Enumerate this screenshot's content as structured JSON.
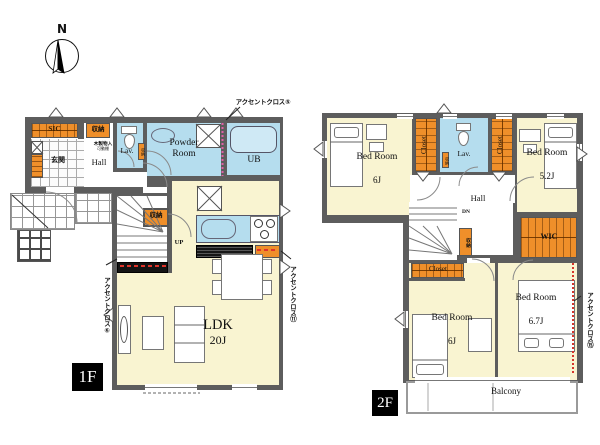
{
  "colors": {
    "wall": "#5d5d5d",
    "room_cream": "#f9f4d1",
    "wet_blue": "#b5ddee",
    "storage_orange": "#ef8f2a",
    "accent_pink": "#e160a8",
    "accent_red": "#d6352b"
  },
  "compass": {
    "north": "N"
  },
  "f1": {
    "badge": "1F",
    "sic": "SIC",
    "storage_top": "収納",
    "genkan": "玄関",
    "hall": "Hall",
    "wood_shelf": "木製物入",
    "wood_shelf_sub": "可動棚",
    "lav": "Lav.",
    "lav_storage": "収納",
    "powder_room": "Powder Room",
    "ub": "UB",
    "stair_storage": "収納",
    "up": "UP",
    "ldk": "LDK",
    "ldk_size": "20J",
    "accent_top": "アクセントクロス⑤",
    "accent_left": "アクセントクロス⑥",
    "accent_right": "アクセントクロス⑪"
  },
  "f2": {
    "badge": "2F",
    "bed_nw": "Bed Room",
    "bed_nw_size": "6J",
    "closet_w": "Closet",
    "lav": "Lav.",
    "lav_storage": "収納",
    "closet_e": "Closet",
    "bed_ne": "Bed Room",
    "bed_ne_size": "5.2J",
    "hall": "Hall",
    "dn": "DN",
    "stair_storage": "収納",
    "closet_s": "Closet",
    "wic": "WIC",
    "bed_sw": "Bed Room",
    "bed_sw_size": "6J",
    "bed_se": "Bed Room",
    "bed_se_size": "6.7J",
    "balcony": "Balcony",
    "accent_right": "アクセントクロス⑮"
  }
}
